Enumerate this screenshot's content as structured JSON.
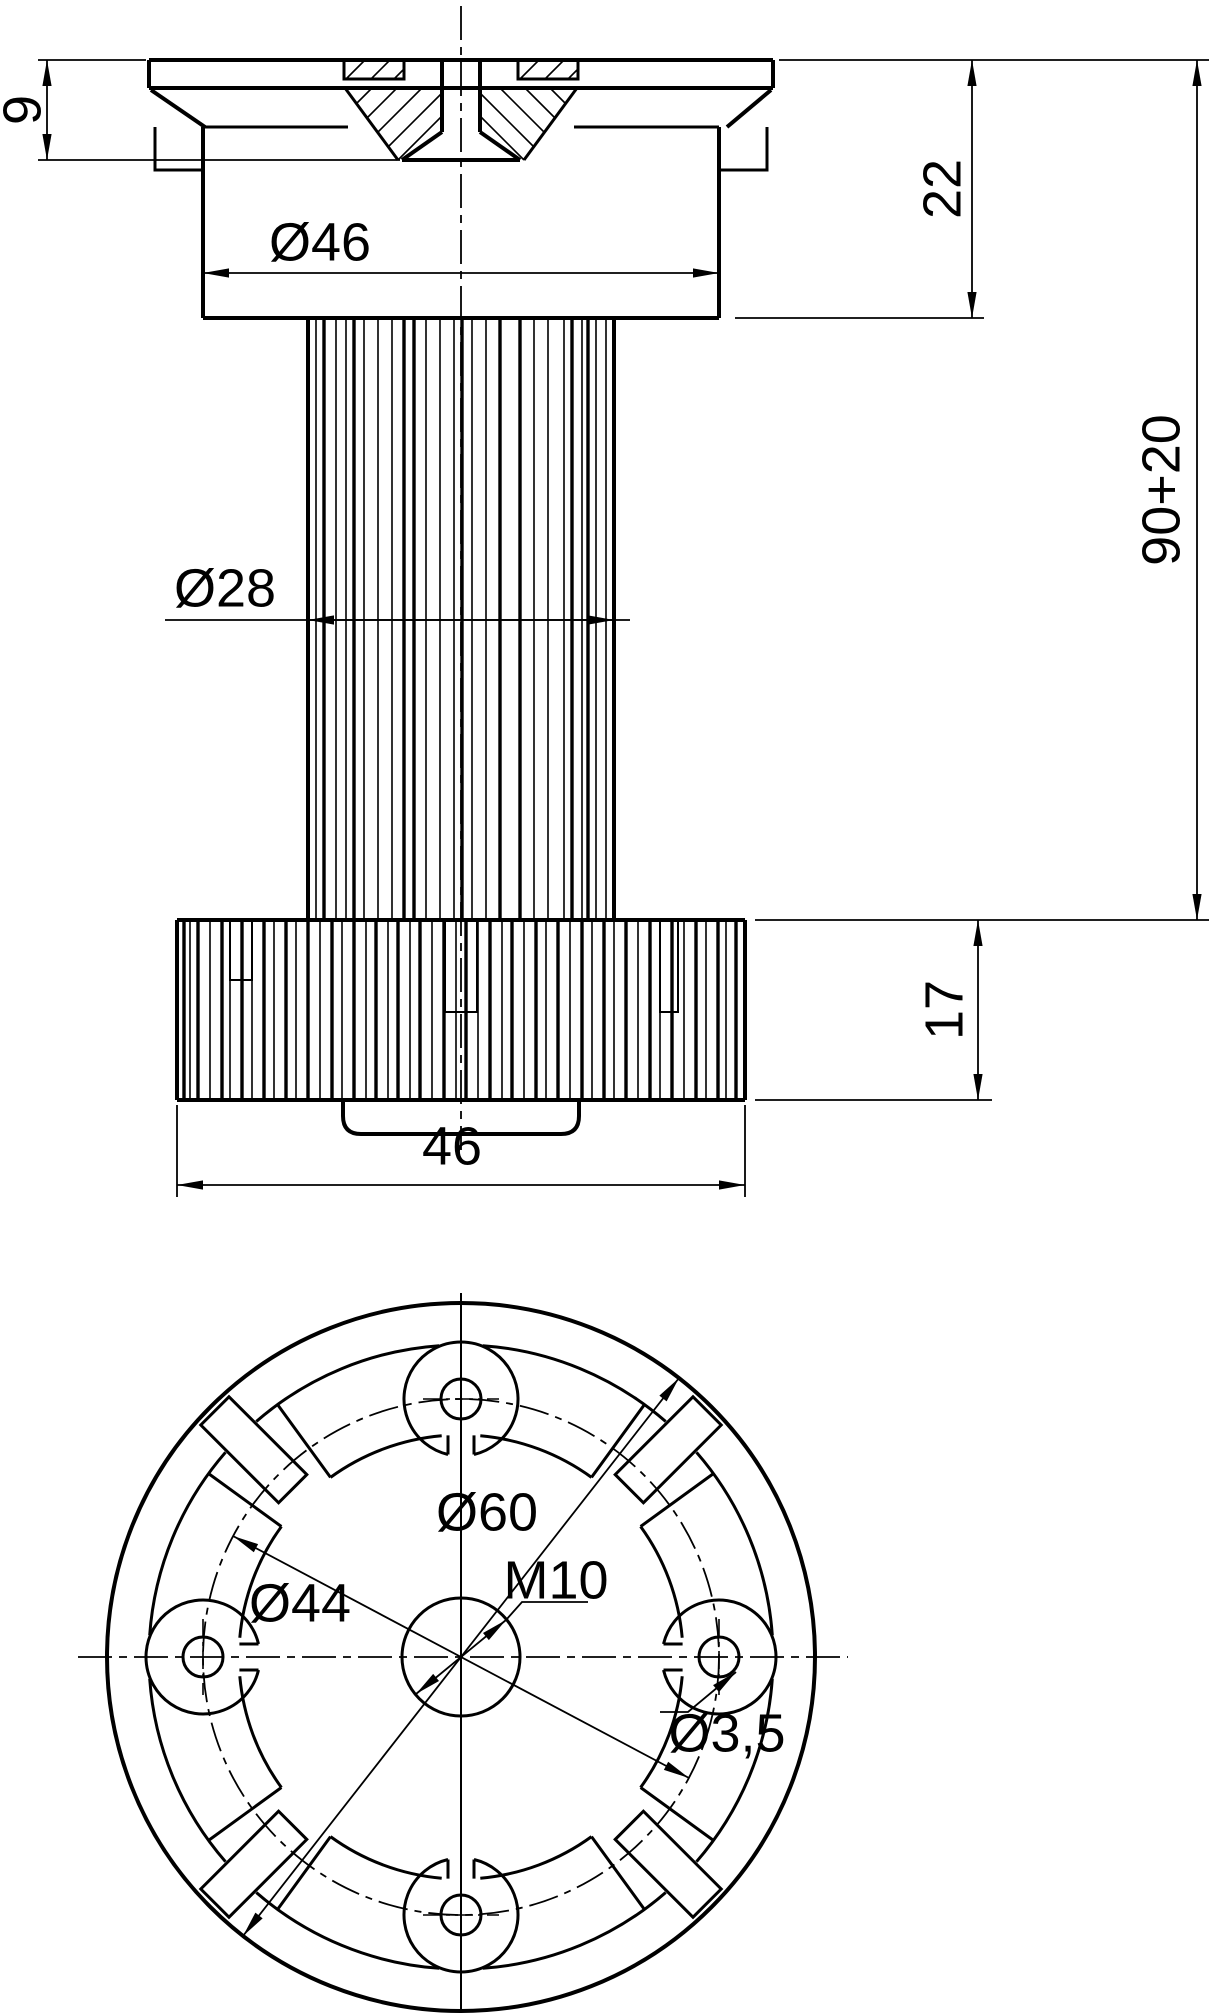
{
  "drawing": {
    "title": "adjustable-foot-technical-drawing",
    "colors": {
      "line": "#000000",
      "background": "#ffffff"
    },
    "side_view": {
      "dim_flange_thickness": "9",
      "dim_collar_diameter": "Ø46",
      "dim_collar_height": "22",
      "dim_overall_height": "90+20",
      "dim_column_diameter": "Ø28",
      "dim_base_height": "17",
      "dim_base_width": "46"
    },
    "bottom_view": {
      "dim_outer_diameter": "Ø60",
      "dim_bolt_circle_diameter": "Ø44",
      "dim_center_thread": "M10",
      "dim_screw_hole_diameter": "Ø3,5"
    }
  }
}
